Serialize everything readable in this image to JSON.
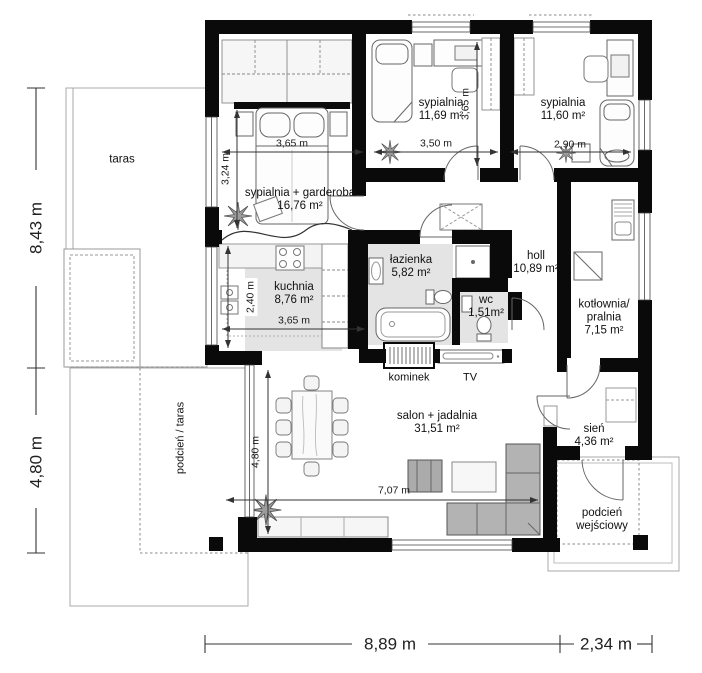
{
  "plan": {
    "rooms": {
      "master": {
        "name": "sypialnia + garderoba",
        "area": "16,76 m²"
      },
      "bedroom1": {
        "name": "sypialnia",
        "area": "11,69 m²"
      },
      "bedroom2": {
        "name": "sypialnia",
        "area": "11,60 m²"
      },
      "kitchen": {
        "name": "kuchnia",
        "area": "8,76 m²"
      },
      "bathroom": {
        "name": "łazienka",
        "area": "5,82 m²"
      },
      "wc": {
        "name": "wc",
        "area": "1,51m²"
      },
      "hall": {
        "name": "holl",
        "area": "10,89 m²"
      },
      "boiler": {
        "name1": "kotłownia/",
        "name2": "pralnia",
        "area": "7,15 m²"
      },
      "living": {
        "name": "salon + jadalnia",
        "area": "31,51 m²"
      },
      "vestibule": {
        "name": "sień",
        "area": "4,36 m²"
      }
    },
    "outdoor": {
      "terrace": "taras",
      "covered_terrace": "podcień / taras",
      "porch_line1": "podcień",
      "porch_line2": "wejściowy"
    },
    "features": {
      "fireplace": "kominek",
      "tv": "TV"
    },
    "dimensions": {
      "left_upper": "8,43 m",
      "left_lower": "4,80 m",
      "bottom_main": "8,89 m",
      "bottom_side": "2,34 m",
      "master_width": "3,65 m",
      "bedroom1_width": "3,50 m",
      "bedroom2_width": "2,90 m",
      "bedroom1_depth": "3,65 m",
      "master_depth": "3,24 m",
      "kitchen_depth": "2,40 m",
      "kitchen_width": "3,65 m",
      "living_depth": "4,80 m",
      "living_width": "7,07 m"
    },
    "colors": {
      "wall": "#0a0a0a",
      "room_shade": "#e4e4e4",
      "sofa": "#b3b3b3",
      "dim": "#333333"
    }
  }
}
